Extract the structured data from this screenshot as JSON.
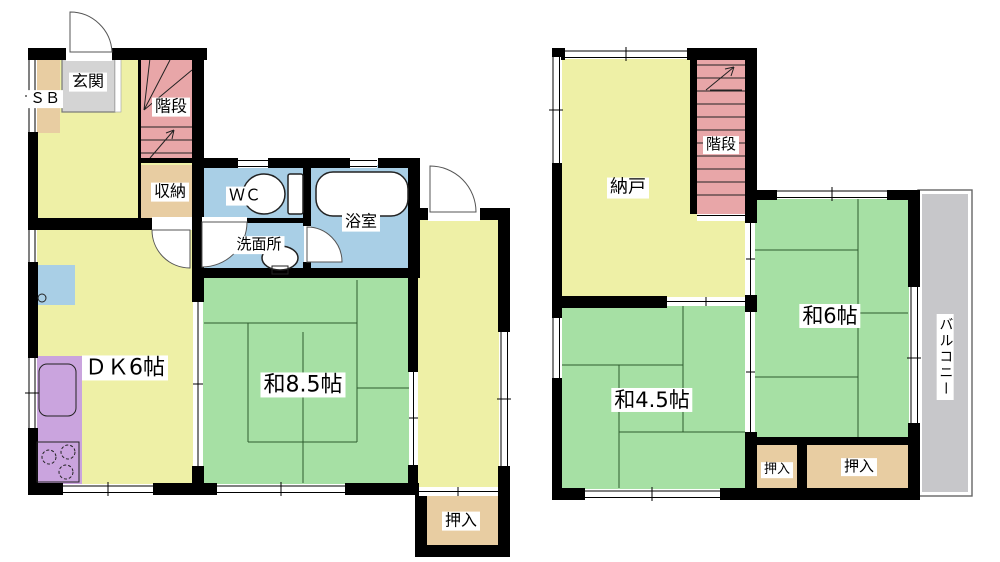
{
  "colors": {
    "floor_yellow": "#eef0a6",
    "tatami_green": "#a6e0a4",
    "wet_blue": "#a9cfe6",
    "stair_pink": "#e8a6a8",
    "closet_tan": "#e8cda2",
    "kitchen_purple": "#caa4de",
    "genkan_gray": "#d4d4d4",
    "balcony_gray": "#c7c7ca",
    "wall": "#000000",
    "tatami_line": "#2e5c2e"
  },
  "floor1": {
    "genkan": "玄関",
    "shoe_box": "ＳＢ",
    "stairs": "階段",
    "storage": "収納",
    "toilet": "ＷＣ",
    "bathroom": "浴室",
    "washroom": "洗面所",
    "dining_kitchen": "ＤＫ6帖",
    "tatami_room": "和8.5帖",
    "closet": "押入"
  },
  "floor2": {
    "storeroom": "納戸",
    "stairs": "階段",
    "tatami_room_6": "和6帖",
    "tatami_room_45": "和4.5帖",
    "closet_small": "押入",
    "closet_large": "押入",
    "balcony": "バルコニー"
  }
}
